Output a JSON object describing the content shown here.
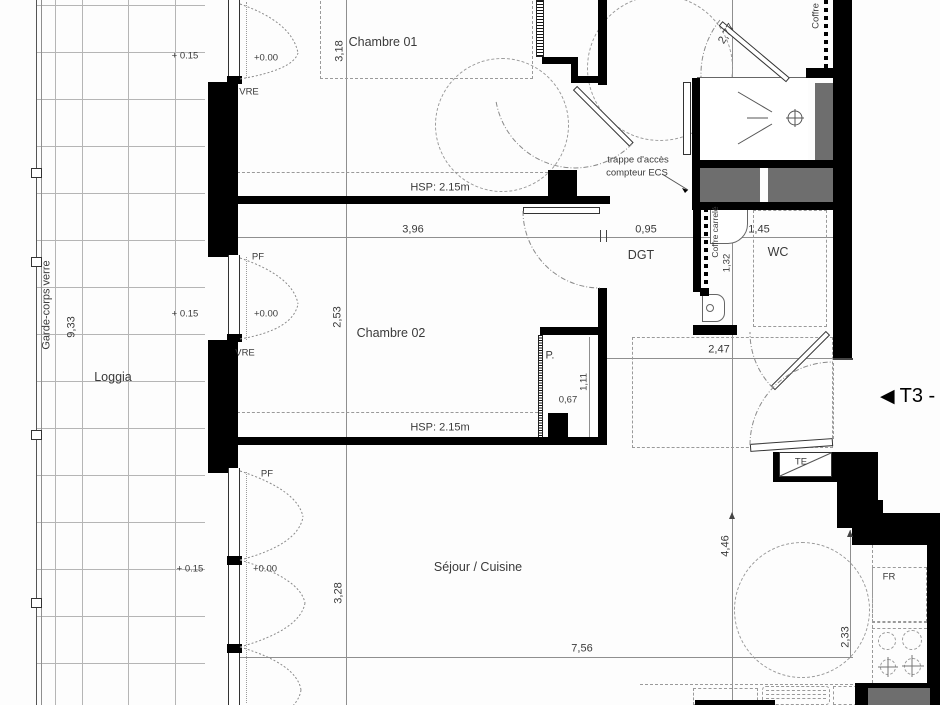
{
  "labels": {
    "chambre01": "Chambre 01",
    "chambre02": "Chambre 02",
    "sejour": "Séjour / Cuisine",
    "loggia": "Loggia",
    "dgt": "DGT",
    "wc": "WC",
    "p_closet": "P.",
    "te": "TE",
    "fr": "FR",
    "garde_corps": "Garde-corps verre",
    "coffre_carrele": "Coffre carrelé",
    "coffre_top": "Coffre",
    "trappe_line1": "trappe d'accès",
    "trappe_line2": "compteur ECS",
    "hsp1": "HSP: 2.15m",
    "hsp2": "HSP: 2.15m",
    "pf1": "PF",
    "pf2": "PF",
    "pf3": "PF",
    "vre1": "VRE",
    "vre2": "VRE",
    "lvl000_1": "+0.00",
    "lvl000_2": "+0.00",
    "lvl000_3": "+0.00",
    "lvl015_1": "+ 0.15",
    "lvl015_2": "+ 0.15",
    "lvl015_3": "+ 0.15",
    "t3_arrow": "◀",
    "t3_text": "T3 -"
  },
  "dimensions": {
    "d318": "3,18",
    "d277": "2,77",
    "d396": "3,96",
    "d095": "0,95",
    "d145": "1,45",
    "d132": "1,32",
    "d253": "2,53",
    "d111": "1,11",
    "d067": "0,67",
    "d247": "2,47",
    "d933": "9,33",
    "d328": "3,28",
    "d756": "7,56",
    "d446": "4,46",
    "d233": "2,33"
  },
  "colors": {
    "wall": "#000000",
    "duct": "#6e6e6e",
    "line": "#8f8f8f"
  }
}
